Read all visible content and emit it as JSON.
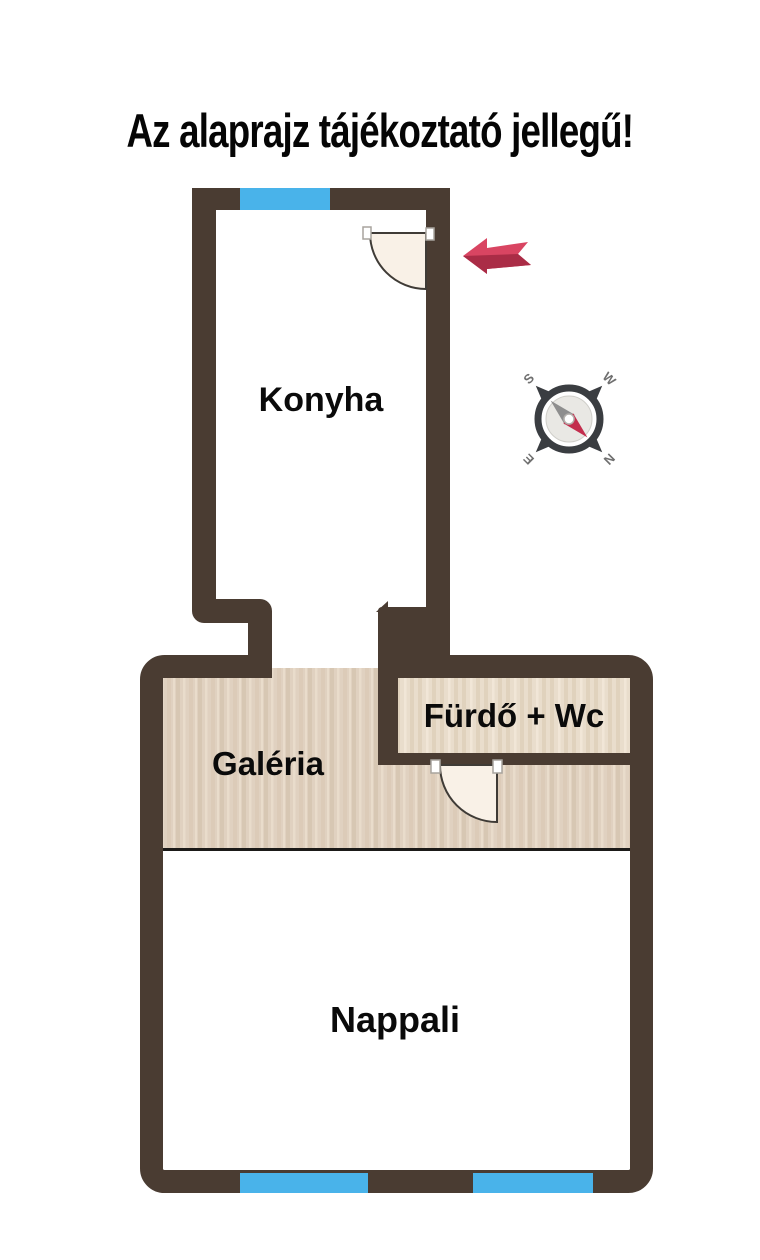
{
  "title": {
    "text": "Az alaprajz tájékoztató jellegű!"
  },
  "rooms": {
    "kitchen": {
      "label": "Konyha"
    },
    "gallery": {
      "label": "Galéria"
    },
    "bathroom": {
      "label": "Fürdő + Wc"
    },
    "living": {
      "label": "Nappali"
    }
  },
  "compass": {
    "north": "N",
    "south": "S",
    "east": "E",
    "west": "W"
  },
  "colors": {
    "wall": "#4a3c32",
    "window": "#49b3ea",
    "wood_floor": "#e0d1c0",
    "bathroom_floor": "#e9ddcc",
    "door_leaf": "#f9f1e7",
    "arrow_red": "#d94562",
    "arrow_red_dark": "#aa2c46",
    "compass_needle_red": "#c32d4d",
    "compass_needle_gray": "#8e8e8e",
    "compass_ring": "#3a3d41",
    "title_text": "#050505"
  }
}
